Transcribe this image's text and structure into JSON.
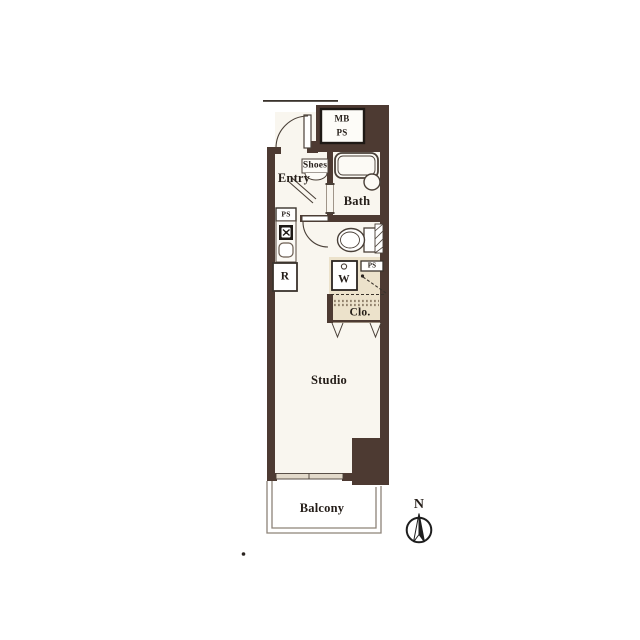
{
  "plan": {
    "type": "apartment-floor-plan",
    "labels": {
      "meter_box": "MB",
      "meter_ps": "PS",
      "entry": "Entry",
      "shoes": "Shoes",
      "bath": "Bath",
      "kitchen_ps": "PS",
      "refrigerator": "R",
      "washer": "W",
      "upper_ps": "PS",
      "closet": "Clo.",
      "studio": "Studio",
      "balcony": "Balcony",
      "compass_north": "N"
    },
    "colors": {
      "wall": "#4d3a32",
      "interior": "#f9f6ef",
      "closet_fill": "#ece2cb",
      "fixture_line": "#4a4038",
      "text": "#241d18"
    }
  }
}
